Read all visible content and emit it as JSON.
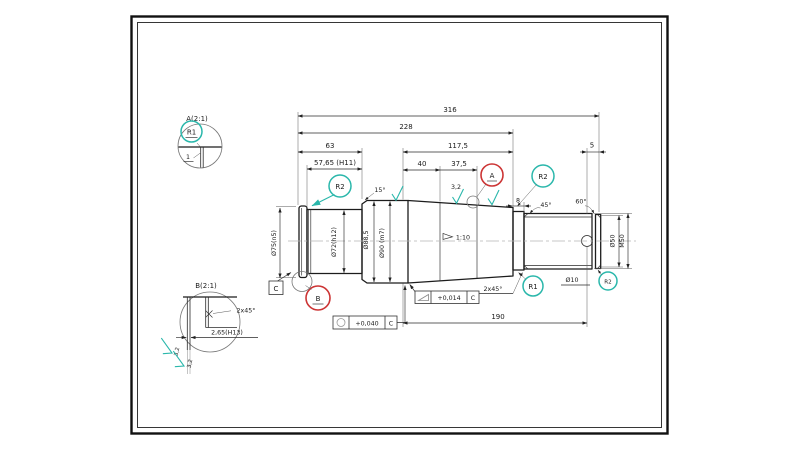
{
  "details": {
    "a": {
      "title": "A(2:1)",
      "radius": "R1",
      "width": "1"
    },
    "b": {
      "title": "B(2:1)",
      "chamfer": "2x45°",
      "width": "2,65(H13)",
      "roughness": "3,2"
    }
  },
  "dims": {
    "len316": "316",
    "len228": "228",
    "len63": "63",
    "len5765": "57,65 (H11)",
    "len1175": "117,5",
    "len40": "40",
    "len375": "37,5",
    "len5": "5",
    "len8": "8",
    "len190": "190"
  },
  "dia": {
    "d75": "Ø75(n5)",
    "d72": "Ø72(h12)",
    "d885": "Ø88,5",
    "d90": "Ø90 (m7)",
    "d50": "Ø50",
    "m50": "M50",
    "d10": "Ø10"
  },
  "callouts": {
    "a": "A",
    "b": "B",
    "r1": "R1",
    "r2": "R2"
  },
  "angles": {
    "a15": "15°",
    "a45": "45°",
    "a60": "60°",
    "chamfer": "2x45°"
  },
  "taper": {
    "ratio": "1:10"
  },
  "surface": {
    "roughness": "3,2"
  },
  "datum": {
    "label": "C"
  },
  "tol": {
    "t1": "+0,014",
    "t2": "+0,040",
    "datum": "C"
  },
  "colors": {
    "teal": "#2ab7ab",
    "red": "#cc3434",
    "line": "#1c1c1c"
  }
}
